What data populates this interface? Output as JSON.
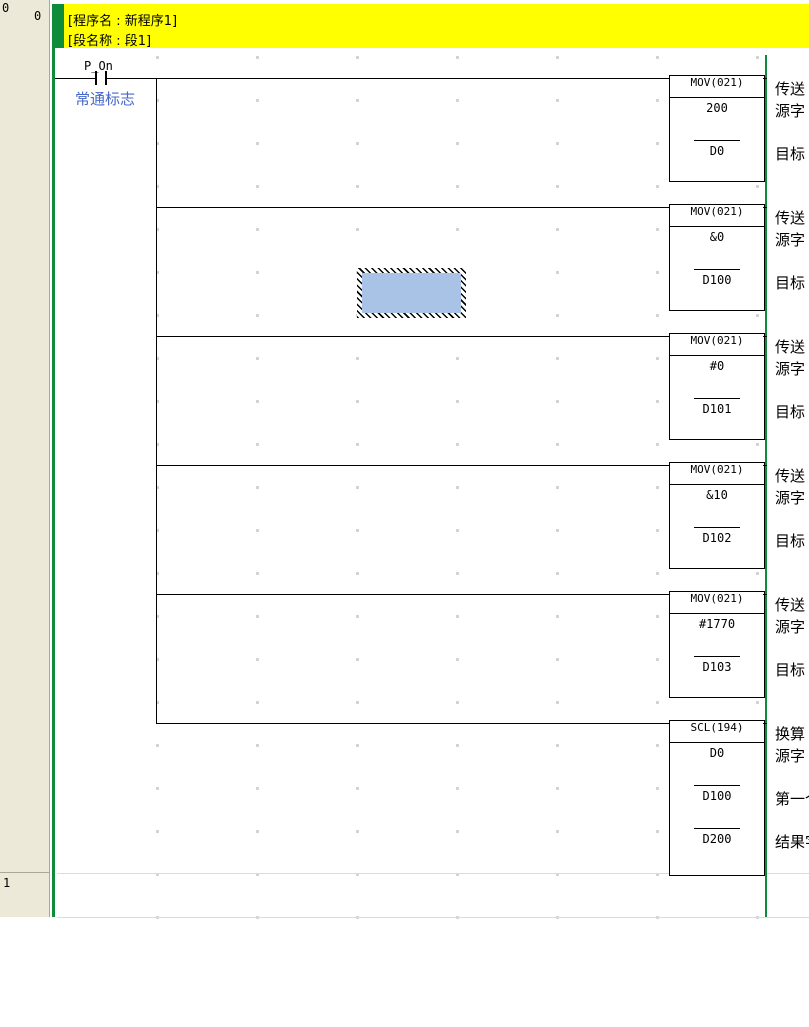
{
  "banner": {
    "program_name_line": "[程序名 : 新程序1]",
    "section_name_line": "[段名称 : 段1]"
  },
  "margin": {
    "rung0_number": "0",
    "rung0_step": "0",
    "rung1_number": "1"
  },
  "contact": {
    "label": "P_On",
    "comment": "常通标志"
  },
  "blocks": [
    {
      "title": "MOV(021)",
      "instruction_label": "传送",
      "operands": [
        {
          "value": "200",
          "label": "源字"
        },
        {
          "value": "D0",
          "label": "目标"
        }
      ]
    },
    {
      "title": "MOV(021)",
      "instruction_label": "传送",
      "operands": [
        {
          "value": "&0",
          "label": "源字"
        },
        {
          "value": "D100",
          "label": "目标"
        }
      ]
    },
    {
      "title": "MOV(021)",
      "instruction_label": "传送",
      "operands": [
        {
          "value": "#0",
          "label": "源字"
        },
        {
          "value": "D101",
          "label": "目标"
        }
      ]
    },
    {
      "title": "MOV(021)",
      "instruction_label": "传送",
      "operands": [
        {
          "value": "&10",
          "label": "源字"
        },
        {
          "value": "D102",
          "label": "目标"
        }
      ]
    },
    {
      "title": "MOV(021)",
      "instruction_label": "传送",
      "operands": [
        {
          "value": "#1770",
          "label": "源字"
        },
        {
          "value": "D103",
          "label": "目标"
        }
      ]
    },
    {
      "title": "SCL(194)",
      "instruction_label": "换算",
      "operands": [
        {
          "value": "D0",
          "label": "源字"
        },
        {
          "value": "D100",
          "label": "第一个"
        },
        {
          "value": "D200",
          "label": "结果字"
        }
      ]
    }
  ],
  "colors": {
    "rail_green": "#0E8C3C",
    "banner_yellow": "#FFFF00",
    "margin_beige": "#ECE9D8",
    "comment_blue": "#4668C8",
    "selection_fill": "#A9C3E7"
  }
}
